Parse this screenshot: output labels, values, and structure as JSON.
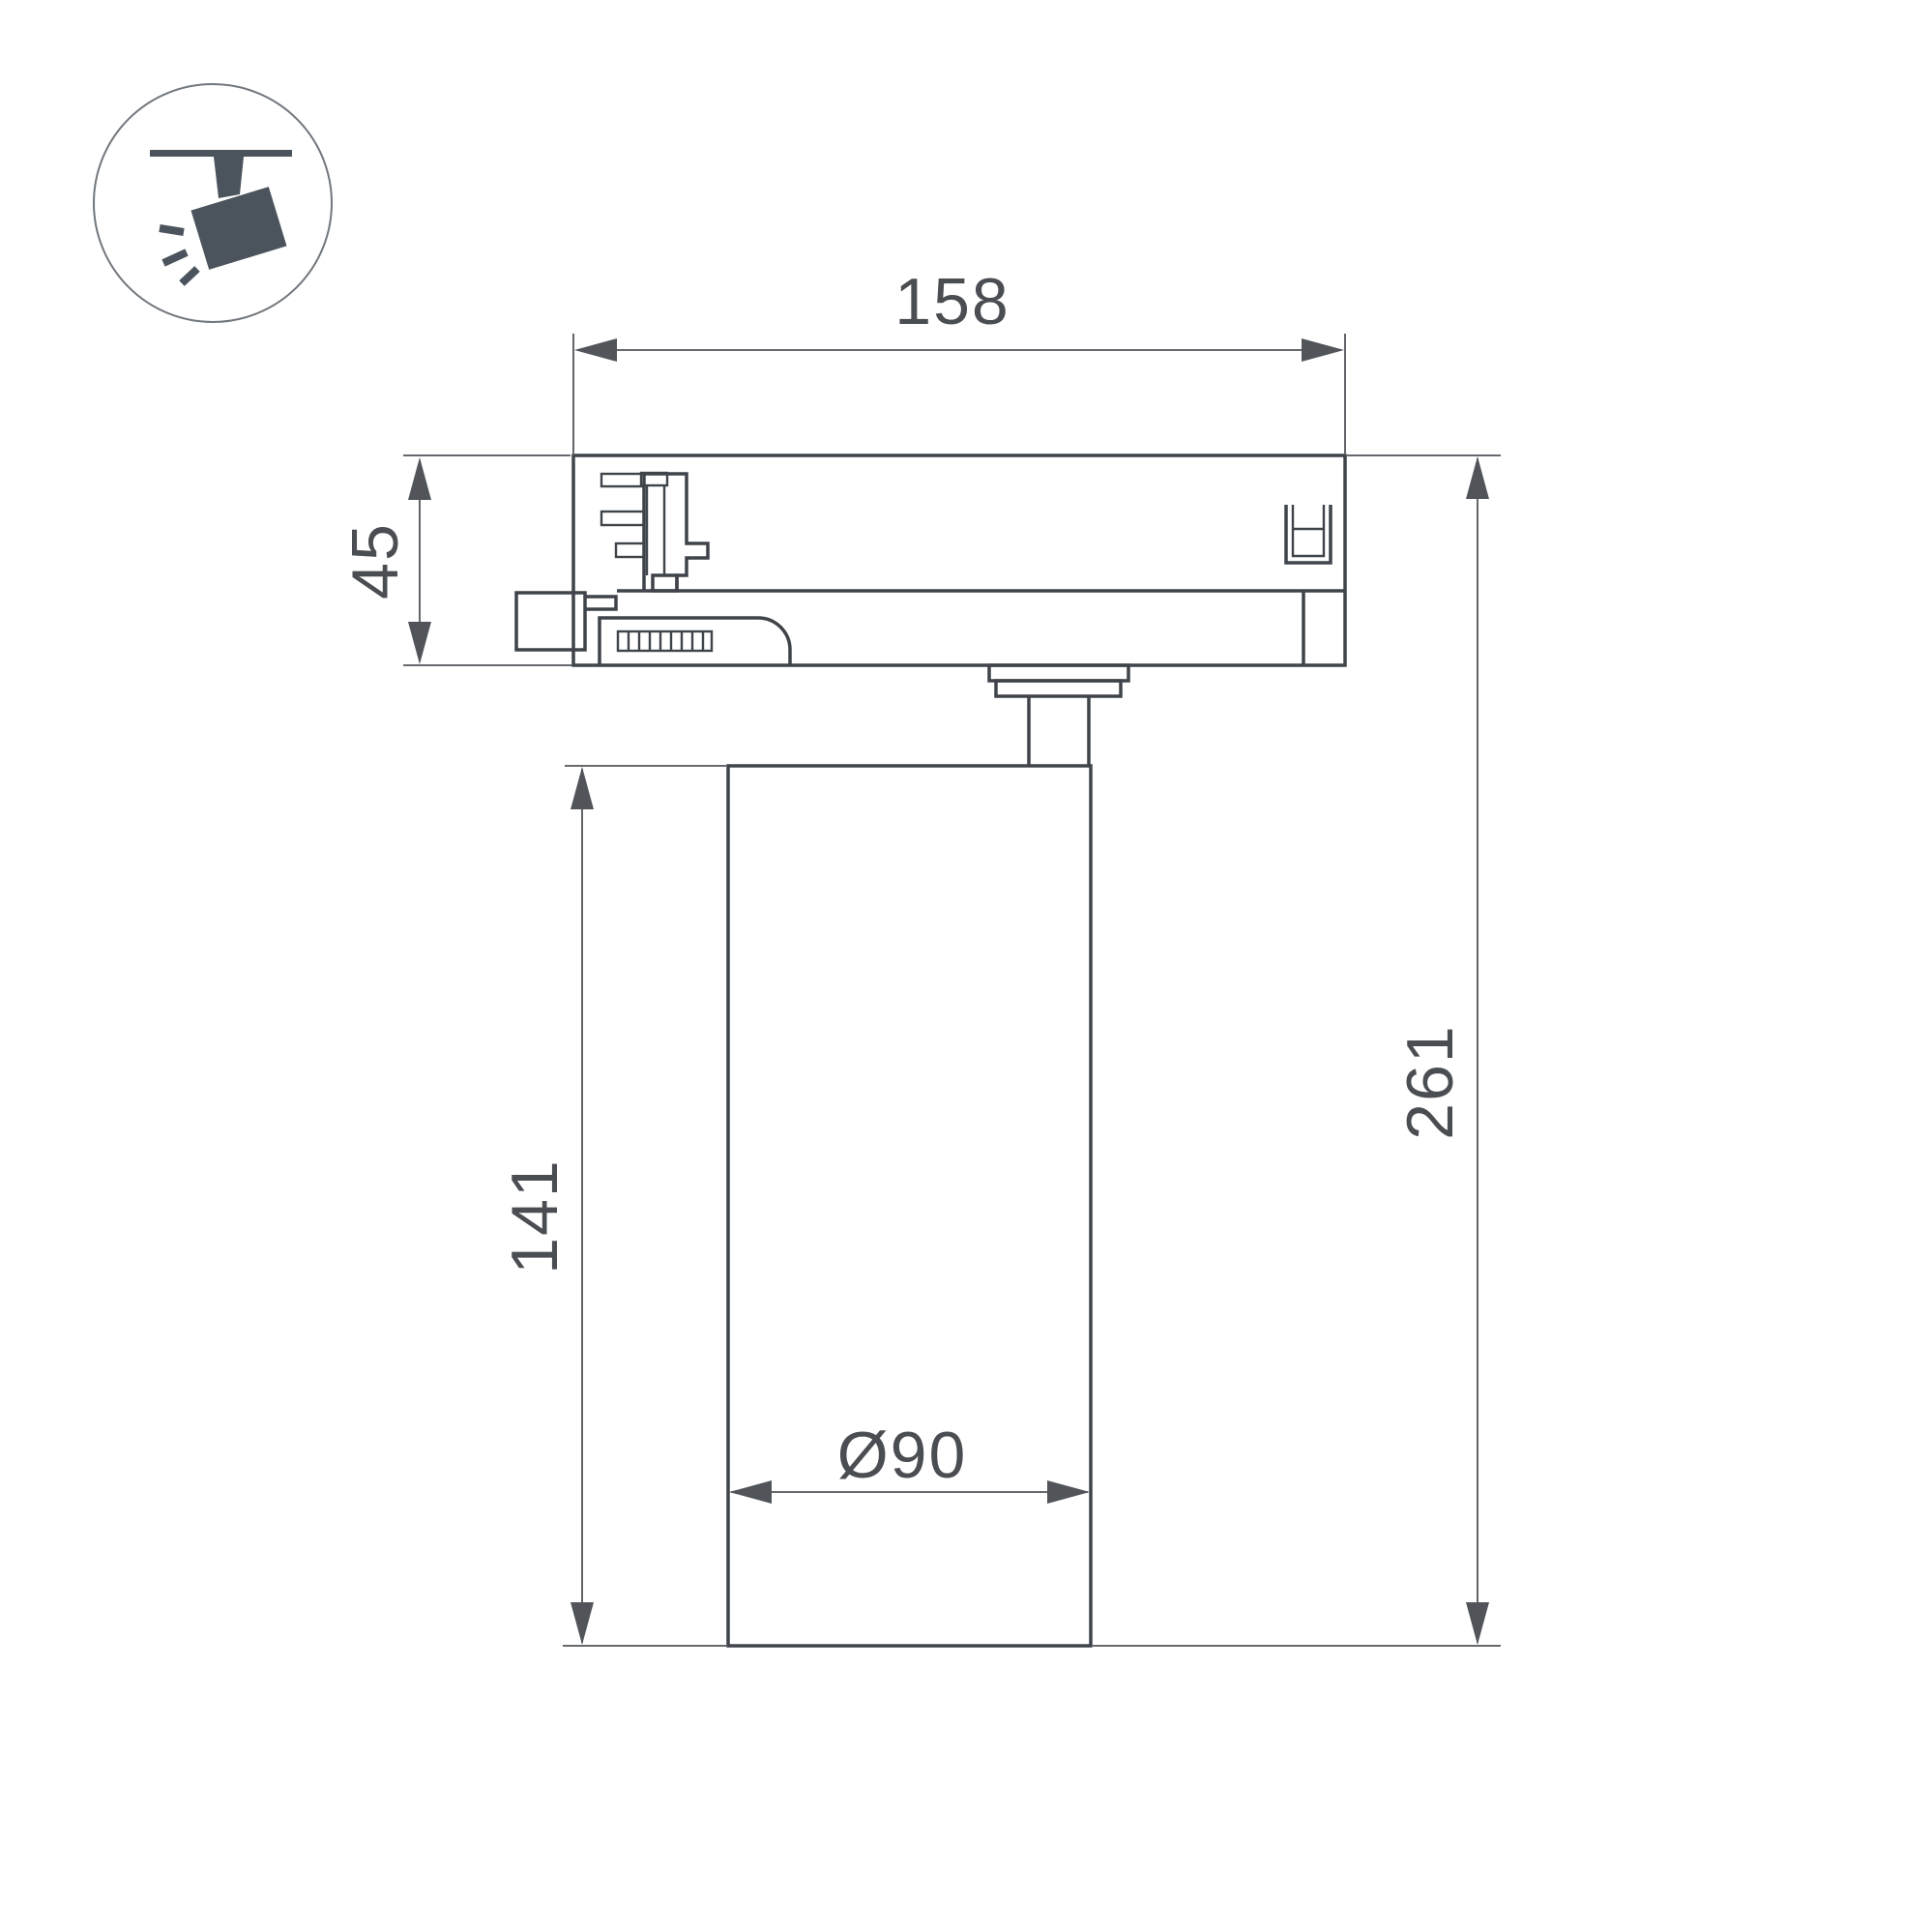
{
  "icon": {
    "name": "track-spotlight-icon",
    "color": "#4b545c",
    "ring_color": "#71777d"
  },
  "labels": {
    "adapter_width": "158",
    "adapter_height": "45",
    "body_height": "141",
    "total_height": "261",
    "body_diameter": "Ø90"
  },
  "colors": {
    "background": "#ffffff",
    "outline": "#3f444a",
    "dimension_line": "#51555a",
    "text": "#4a4d52"
  }
}
